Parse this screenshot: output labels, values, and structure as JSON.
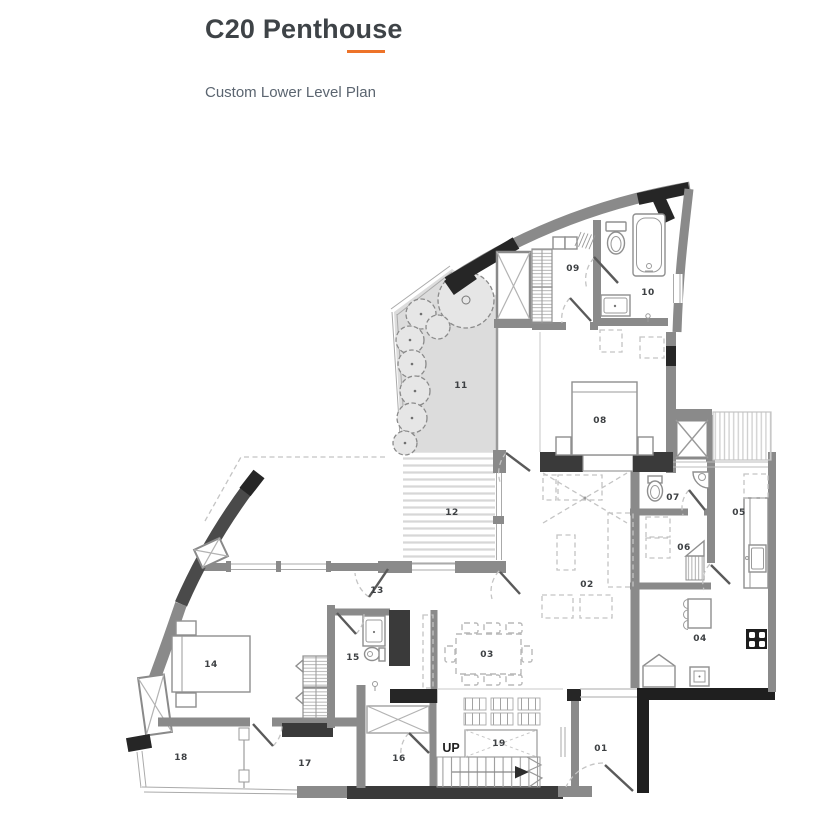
{
  "header": {
    "title": "C20 Penthouse",
    "subtitle": "Custom Lower Level Plan",
    "accent_color": "#ED7329"
  },
  "floorplan": {
    "up_label": "UP",
    "up_pos": {
      "x": 451,
      "y": 752
    },
    "rooms": [
      {
        "label": "01",
        "x": 601,
        "y": 751
      },
      {
        "label": "02",
        "x": 587,
        "y": 587
      },
      {
        "label": "03",
        "x": 487,
        "y": 657
      },
      {
        "label": "04",
        "x": 700,
        "y": 641
      },
      {
        "label": "05",
        "x": 739,
        "y": 515
      },
      {
        "label": "06",
        "x": 684,
        "y": 550
      },
      {
        "label": "07",
        "x": 673,
        "y": 500
      },
      {
        "label": "08",
        "x": 600,
        "y": 423
      },
      {
        "label": "09",
        "x": 573,
        "y": 271
      },
      {
        "label": "10",
        "x": 648,
        "y": 295
      },
      {
        "label": "11",
        "x": 461,
        "y": 388
      },
      {
        "label": "12",
        "x": 452,
        "y": 515
      },
      {
        "label": "13",
        "x": 377,
        "y": 593
      },
      {
        "label": "14",
        "x": 211,
        "y": 667
      },
      {
        "label": "15",
        "x": 353,
        "y": 660
      },
      {
        "label": "16",
        "x": 399,
        "y": 761
      },
      {
        "label": "17",
        "x": 305,
        "y": 766
      },
      {
        "label": "18",
        "x": 181,
        "y": 760
      },
      {
        "label": "19",
        "x": 499,
        "y": 746
      }
    ]
  },
  "colors": {
    "wall_gray": "#8a8a8a",
    "wall_dark": "#3a3a3a",
    "wall_black": "#1f1f1f",
    "terrace_fill": "#dcdcdc",
    "accent": "#ED7329"
  }
}
